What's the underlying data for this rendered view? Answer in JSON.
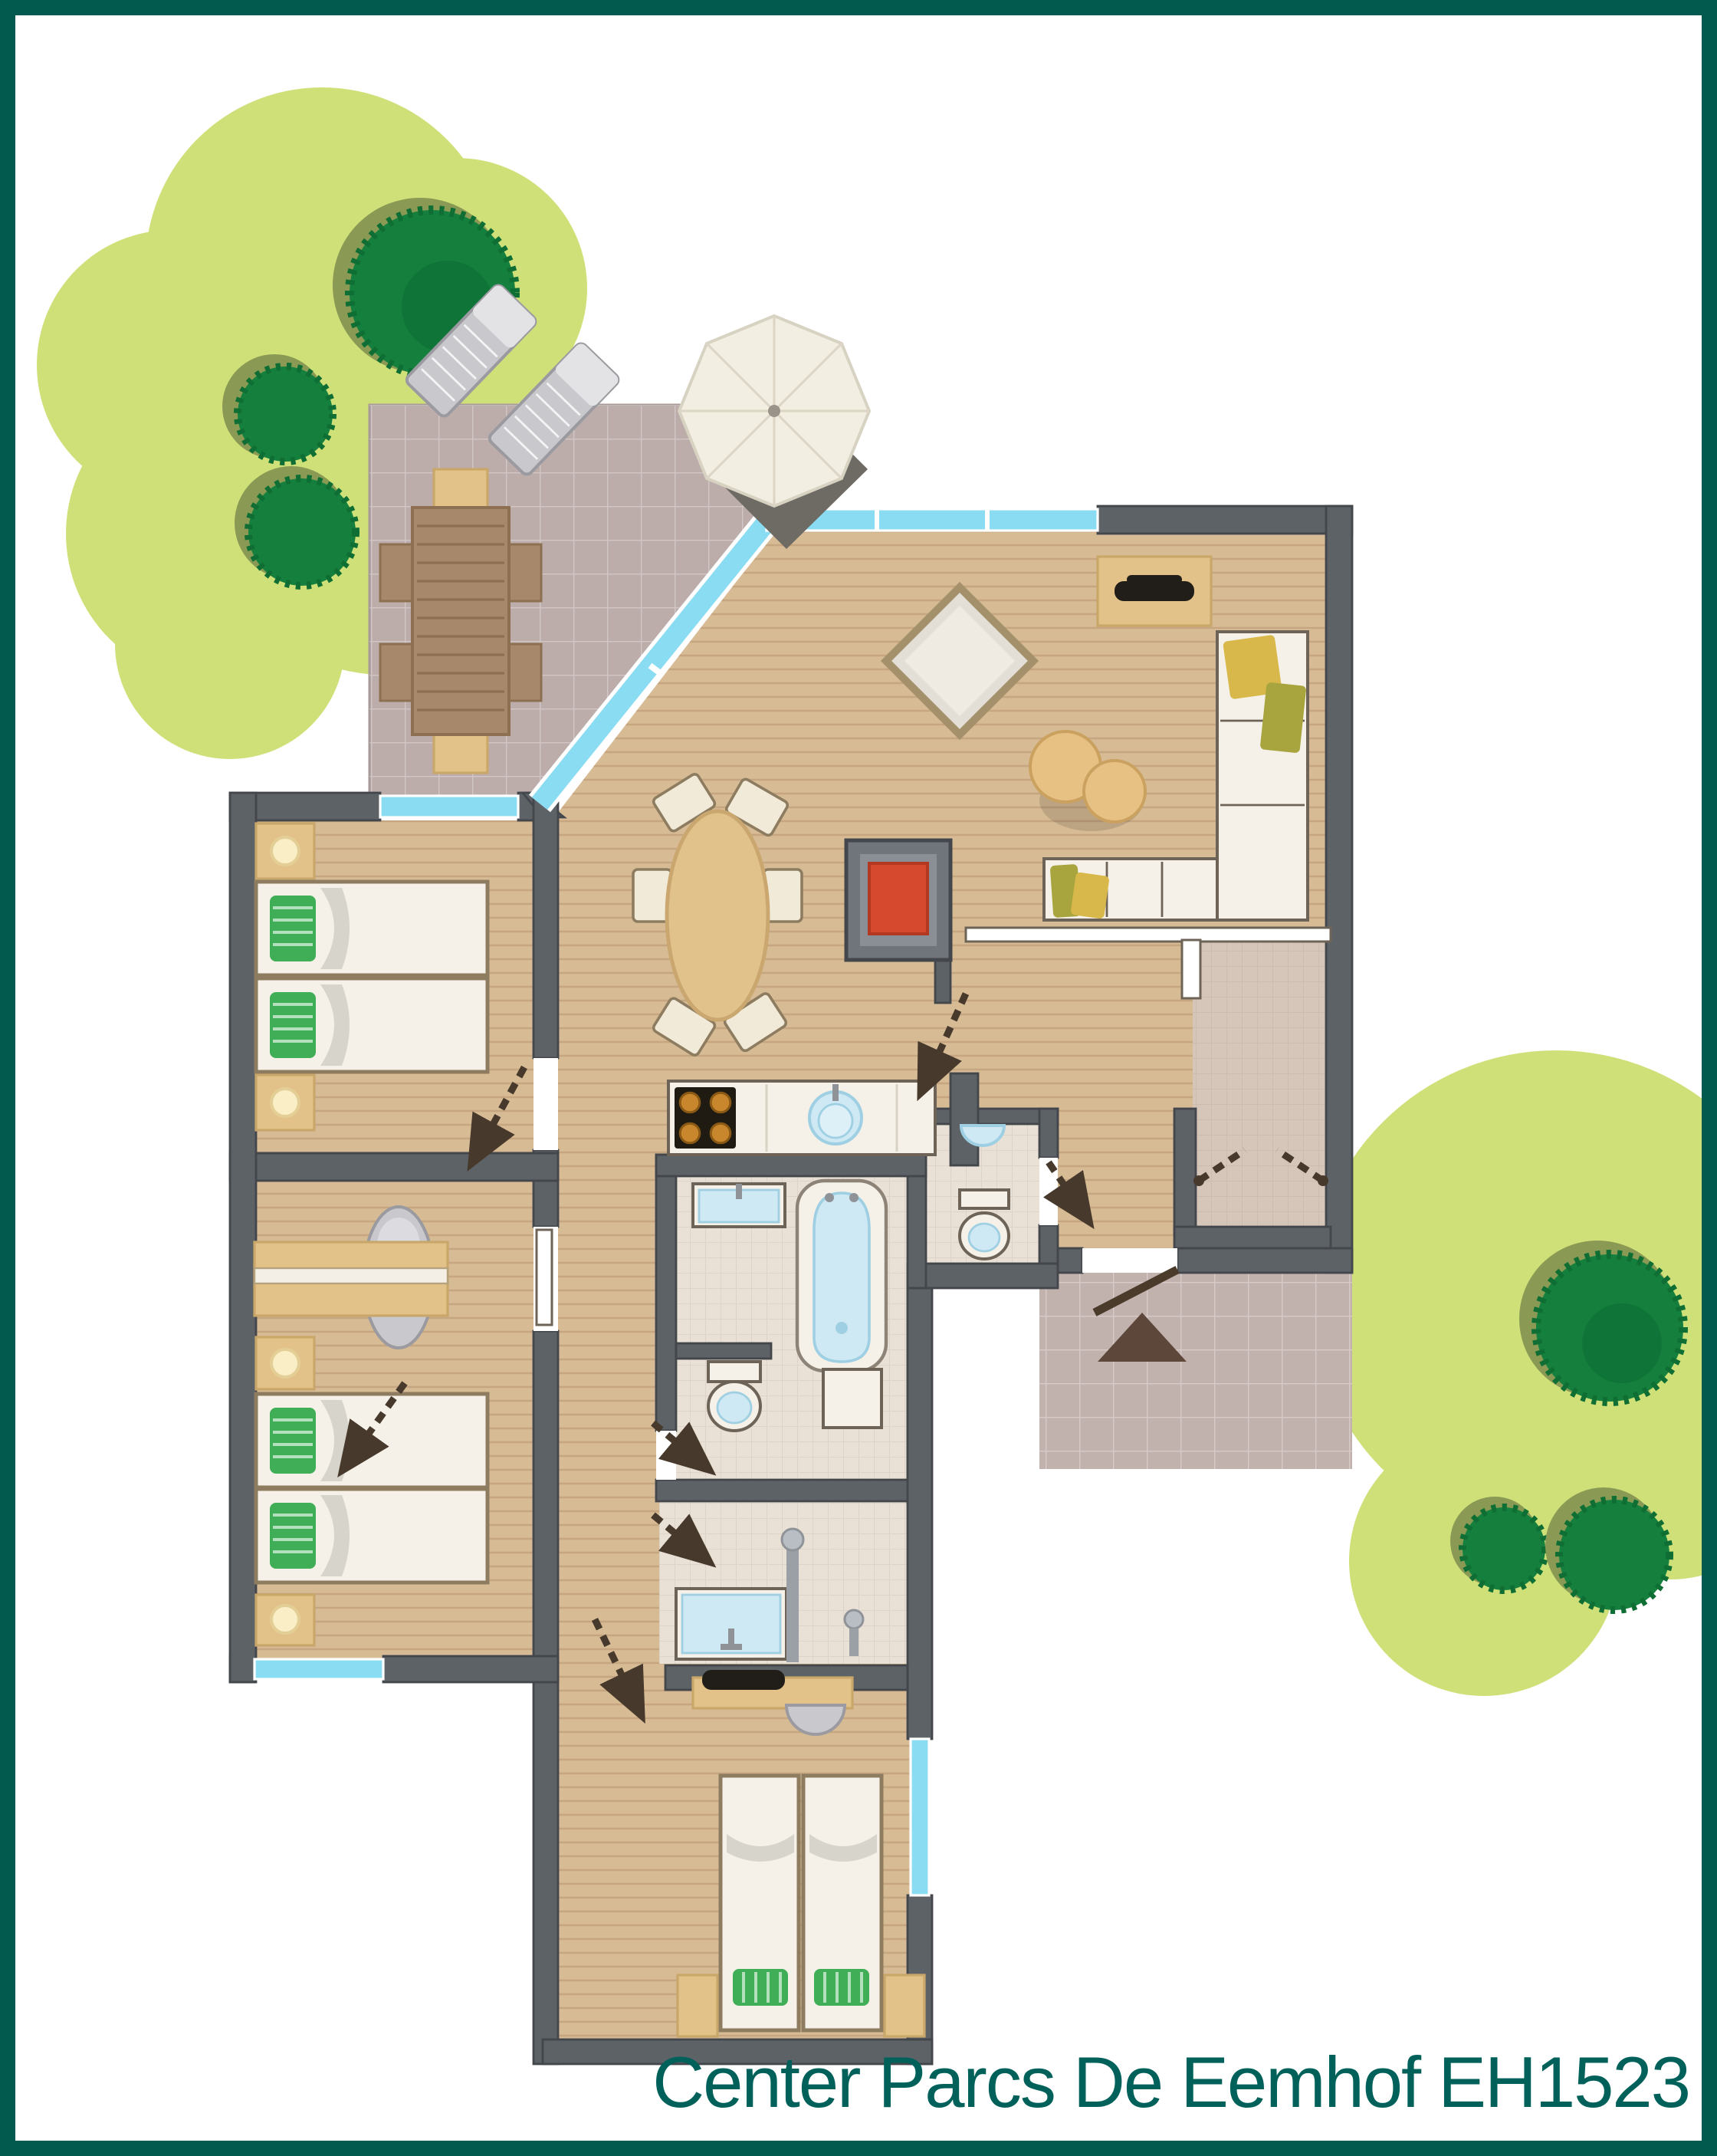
{
  "caption": {
    "text": "Center Parcs De Eemhof EH1523"
  },
  "palette": {
    "frame": "#02594e",
    "caption": "#00615b",
    "grass": "#cfe078",
    "treeDark": "#15803e",
    "treeShadow": "#8a9a55",
    "patio": "#bcadab",
    "path": "#c2b2ae",
    "wall": "#5d6267",
    "wallDark": "#43474c",
    "glass": "#8adcf2",
    "wood": "#d7bb95",
    "tile": "#e9e0d6",
    "storage": "#d6c6ba",
    "furnWhite": "#f5f1e9",
    "furnOutline": "#6e6357",
    "tan": "#e3c289",
    "tanDark": "#c9a76a",
    "bedGreen": "#3fae57",
    "lamp": "#f9eec6",
    "cushY": "#d8b84a",
    "cushG": "#a8a43e",
    "stoveRed": "#d6492f",
    "tv": "#211d18",
    "woodBrown": "#a8886a",
    "brown": "#8d6f52",
    "blue": "#cfe9f4",
    "blueDk": "#9fcfe2",
    "gray": "#c9c9cd",
    "grayDk": "#9a9aa0",
    "doorInk": "#473a2c"
  }
}
